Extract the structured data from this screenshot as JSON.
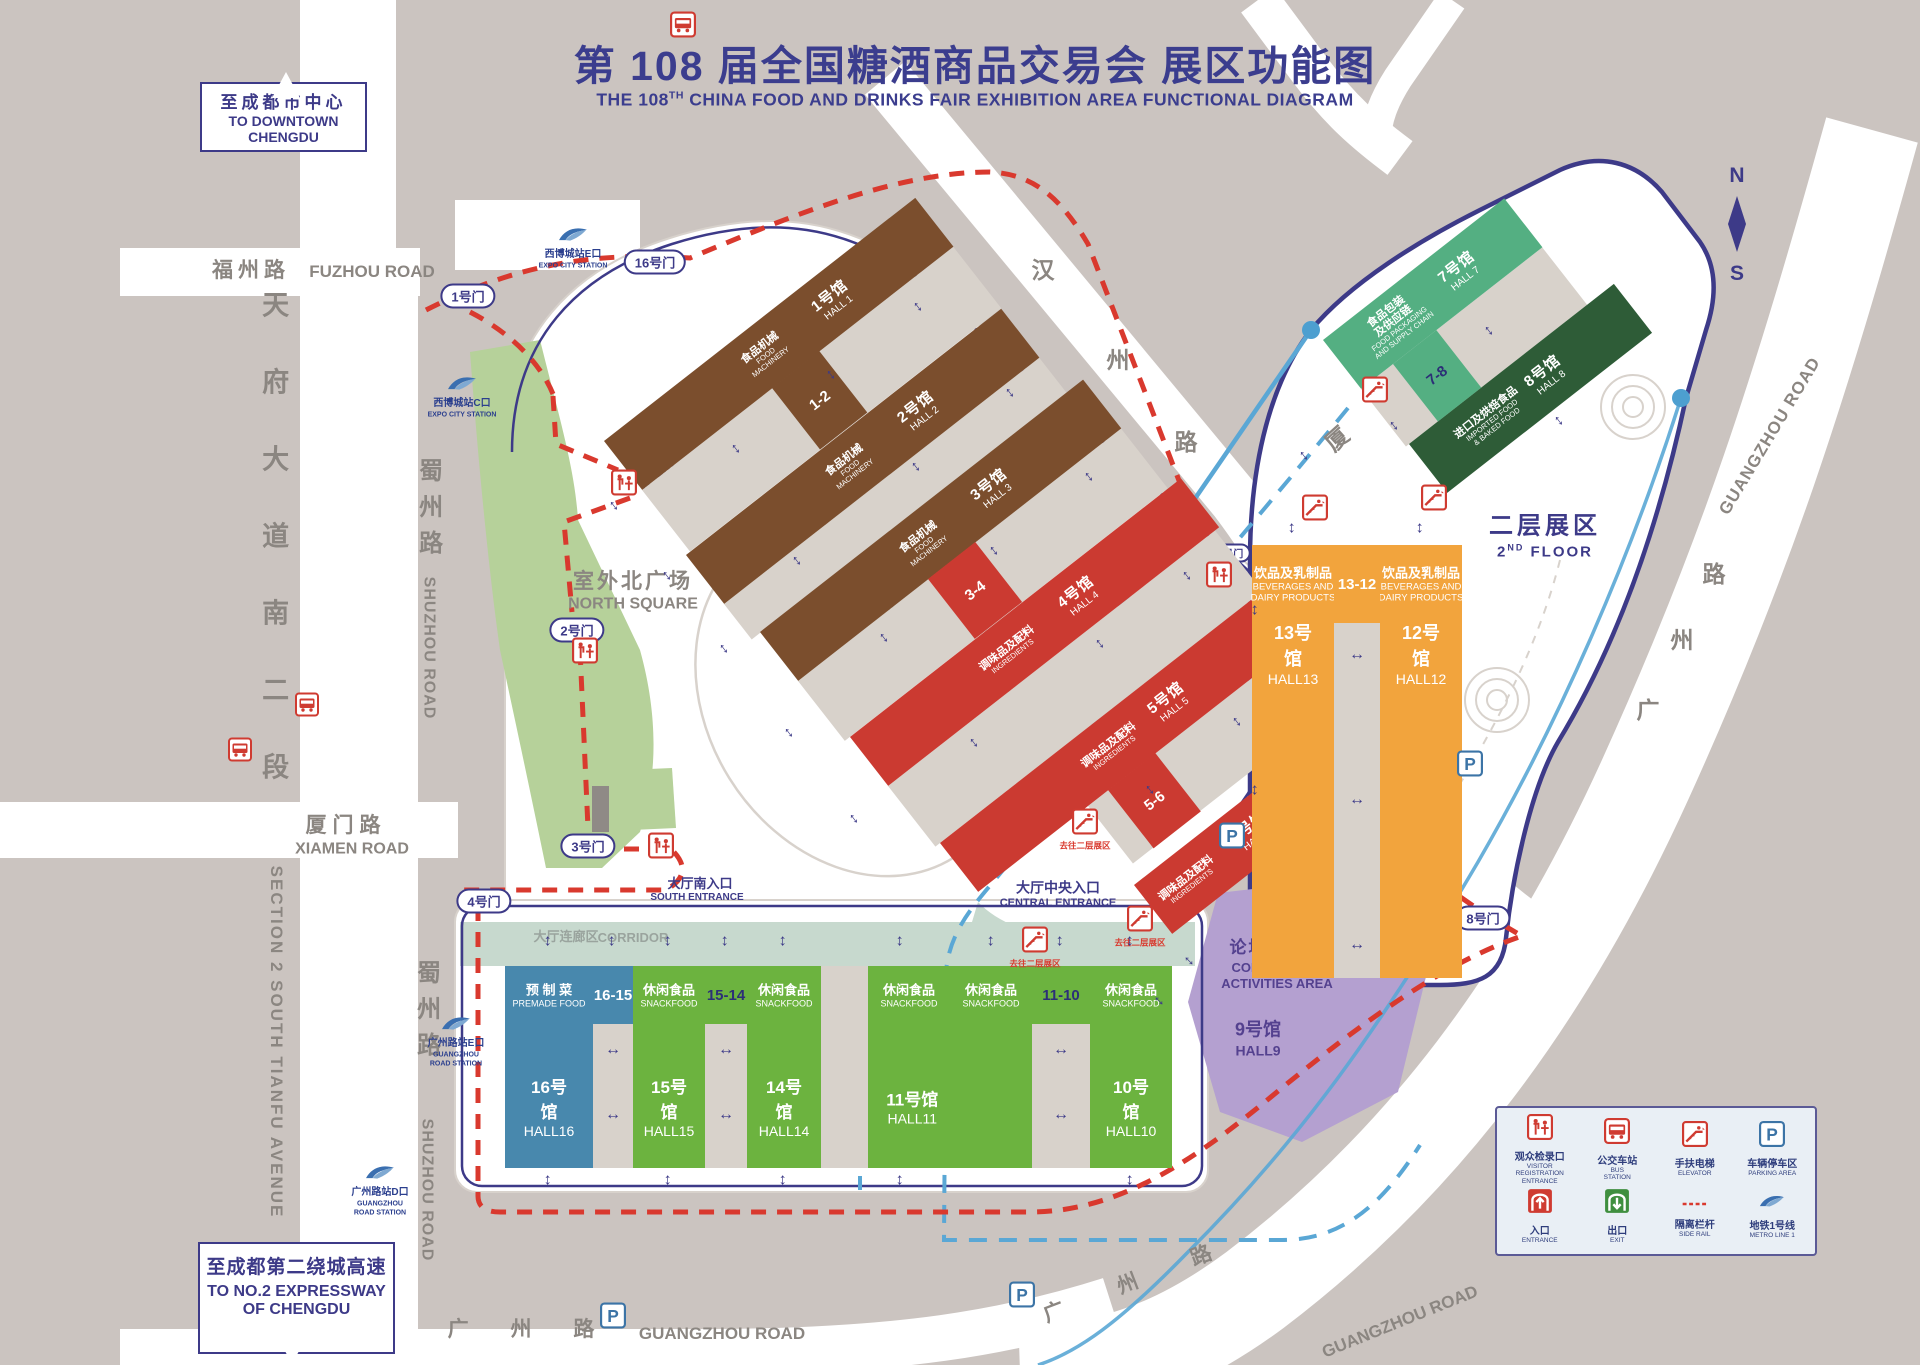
{
  "title": {
    "cn": "第 108 届全国糖酒商品交易会  展区功能图",
    "en1": "THE 108",
    "en_sup": "TH",
    "en2": " CHINA FOOD AND DRINKS FAIR  EXHIBITION AREA FUNCTIONAL DIAGRAM"
  },
  "signs": {
    "downtown": {
      "cn": "至成都市中心",
      "en1": "TO DOWNTOWN",
      "en2": "CHENGDU"
    },
    "expressway": {
      "cn": "至成都第二绕城高速",
      "en1": "TO NO.2 EXPRESSWAY",
      "en2": "OF CHENGDU"
    }
  },
  "compass": {
    "north": "N",
    "south": "S"
  },
  "roads": {
    "fuzhou": {
      "cn": "福州路",
      "en": "FUZHOU ROAD"
    },
    "tianfu": {
      "cn": "天府大道南二段",
      "en": "SECTION 2 SOUTH TIANFU AVENUE"
    },
    "shuzhou": {
      "cn": "蜀州路",
      "en": "SHUZHOU ROAD"
    },
    "xiamen": {
      "cn": "厦门路",
      "en": "XIAMEN ROAD"
    },
    "hanzhou_chars": [
      "汉",
      "州",
      "路"
    ],
    "xia_char": "厦",
    "guangzhou": {
      "cn": "广 州 路",
      "en": "GUANGZHOU ROAD"
    }
  },
  "stations": {
    "expo_e": {
      "cn": "西博城站E口",
      "en": "EXPO CITY STATION"
    },
    "expo_c": {
      "cn": "西博城站C口",
      "en": "EXPO CITY STATION"
    },
    "gz_e": {
      "cn": "广州路站E口",
      "en1": "GUANGZHOU",
      "en2": "ROAD STATION"
    },
    "gz_d": {
      "cn": "广州路站D口",
      "en1": "GUANGZHOU",
      "en2": "ROAD STATION"
    }
  },
  "gates": [
    "1号门",
    "16号门",
    "2号门",
    "3号门",
    "4号门",
    "11号门",
    "8号门"
  ],
  "entrances": {
    "north": {
      "cn": "大厅北入口",
      "en": "NORTH ENTRANCE"
    },
    "south": {
      "cn": "大厅南入口",
      "en": "SOUTH ENTRANCE"
    },
    "central": {
      "cn": "大厅中央入口",
      "en": "CENTRAL ENTRANCE"
    }
  },
  "areas": {
    "north_square": {
      "cn": "室外北广场",
      "en": "NORTH SQUARE"
    },
    "corridor": {
      "cn": "大厅连廊区",
      "en": "CORRIDOR"
    },
    "second_floor": {
      "cn": "二层展区",
      "en1": "2",
      "en_sup": "ND",
      "en2": " FLOOR"
    },
    "conference": {
      "cn": "论坛活动区",
      "en1": "CONFERENCE",
      "en2": "ACTIVITIES AREA"
    }
  },
  "halls": [
    {
      "id": 1,
      "cn": "1号馆",
      "en": "HALL 1",
      "cat_cn": "食品机械",
      "cat_en": "FOOD\nMACHINERY"
    },
    {
      "id": 2,
      "cn": "2号馆",
      "en": "HALL 2",
      "cat_cn": "食品机械",
      "cat_en": "FOOD\nMACHINERY"
    },
    {
      "id": 3,
      "cn": "3号馆",
      "en": "HALL 3",
      "cat_cn": "食品机械",
      "cat_en": "FOOD\nMACHINERY"
    },
    {
      "id": 4,
      "cn": "4号馆",
      "en": "HALL 4",
      "cat_cn": "调味品及配料",
      "cat_en": "INGREDIENTS"
    },
    {
      "id": 5,
      "cn": "5号馆",
      "en": "HALL 5",
      "cat_cn": "调味品及配料",
      "cat_en": "INGREDIENTS"
    },
    {
      "id": 6,
      "cn": "6号馆",
      "en": "HALL 6",
      "cat_cn": "调味品及配料",
      "cat_en": "INGREDIENTS"
    },
    {
      "id": 7,
      "cn": "7号馆",
      "en": "HALL 7",
      "cat_cn": "食品包装\n及供应链",
      "cat_en": "FOOD PACKAGING\nAND SUPPLY CHAIN"
    },
    {
      "id": 8,
      "cn": "8号馆",
      "en": "HALL 8",
      "cat_cn": "进口及烘焙食品",
      "cat_en": "IMPORTED FOOD\n& BAKED FOOD"
    },
    {
      "id": 9,
      "cn": "9号馆",
      "en": "HALL9",
      "cat_cn": "",
      "cat_en": ""
    },
    {
      "id": 10,
      "cn": "10号馆",
      "en": "HALL10",
      "cat_cn": "休闲食品",
      "cat_en": "SNACKFOOD"
    },
    {
      "id": 11,
      "cn": "11号馆",
      "en": "HALL11",
      "cat_cn": "休闲食品",
      "cat_en": "SNACKFOOD"
    },
    {
      "id": 12,
      "cn": "12号馆",
      "en": "HALL12",
      "cat_cn": "饮品及乳制品",
      "cat_en": "BEVERAGES AND\nDAIRY PRODUCTS"
    },
    {
      "id": 13,
      "cn": "13号馆",
      "en": "HALL13",
      "cat_cn": "饮品及乳制品",
      "cat_en": "BEVERAGES AND\nDAIRY PRODUCTS"
    },
    {
      "id": 14,
      "cn": "14号馆",
      "en": "HALL14",
      "cat_cn": "休闲食品",
      "cat_en": "SNACKFOOD"
    },
    {
      "id": 15,
      "cn": "15号馆",
      "en": "HALL15",
      "cat_cn": "休闲食品",
      "cat_en": "SNACKFOOD"
    },
    {
      "id": 16,
      "cn": "16号馆",
      "en": "HALL16",
      "cat_cn": "预 制 菜",
      "cat_en": "PREMADE FOOD"
    }
  ],
  "connectors": [
    "1-2",
    "3-4",
    "5-6",
    "7-8",
    "13-12",
    "16-15",
    "15-14",
    "11-10"
  ],
  "escalator_note": "去往二层展区",
  "legend": [
    {
      "cn": "观众检录口",
      "en": "VISITOR\nREGISTRATION\nENTRANCE",
      "icon": "visitor-registration-icon"
    },
    {
      "cn": "公交车站",
      "en": "BUS\nSTATION",
      "icon": "bus-icon"
    },
    {
      "cn": "手扶电梯",
      "en": "ELEVATOR",
      "icon": "escalator-icon"
    },
    {
      "cn": "车辆停车区",
      "en": "PARKING AREA",
      "icon": "parking-icon"
    },
    {
      "cn": "入口",
      "en": "ENTRANCE",
      "icon": "entrance-icon"
    },
    {
      "cn": "出口",
      "en": "EXIT",
      "icon": "exit-icon"
    },
    {
      "cn": "隔离栏杆",
      "en": "SIDE RAIL",
      "icon": "side-rail-icon"
    },
    {
      "cn": "地铁1号线",
      "en": "METRO LINE 1",
      "icon": "metro-icon"
    }
  ],
  "colors": {
    "machinery_brown": "#7b4e2d",
    "ingredients_red": "#cb3a31",
    "packaging_green": "#54af82",
    "imported_darkgreen": "#2e5c37",
    "snack_green": "#6cb33f",
    "beverage_orange": "#f2a43d",
    "premade_blue": "#4888ad",
    "hall9_purple": "#b4a0d0",
    "navy": "#3d3a88",
    "barrier_red": "#d9392e",
    "metro_blue": "#5aa7d5",
    "road_gray_text": "#8b8681"
  }
}
